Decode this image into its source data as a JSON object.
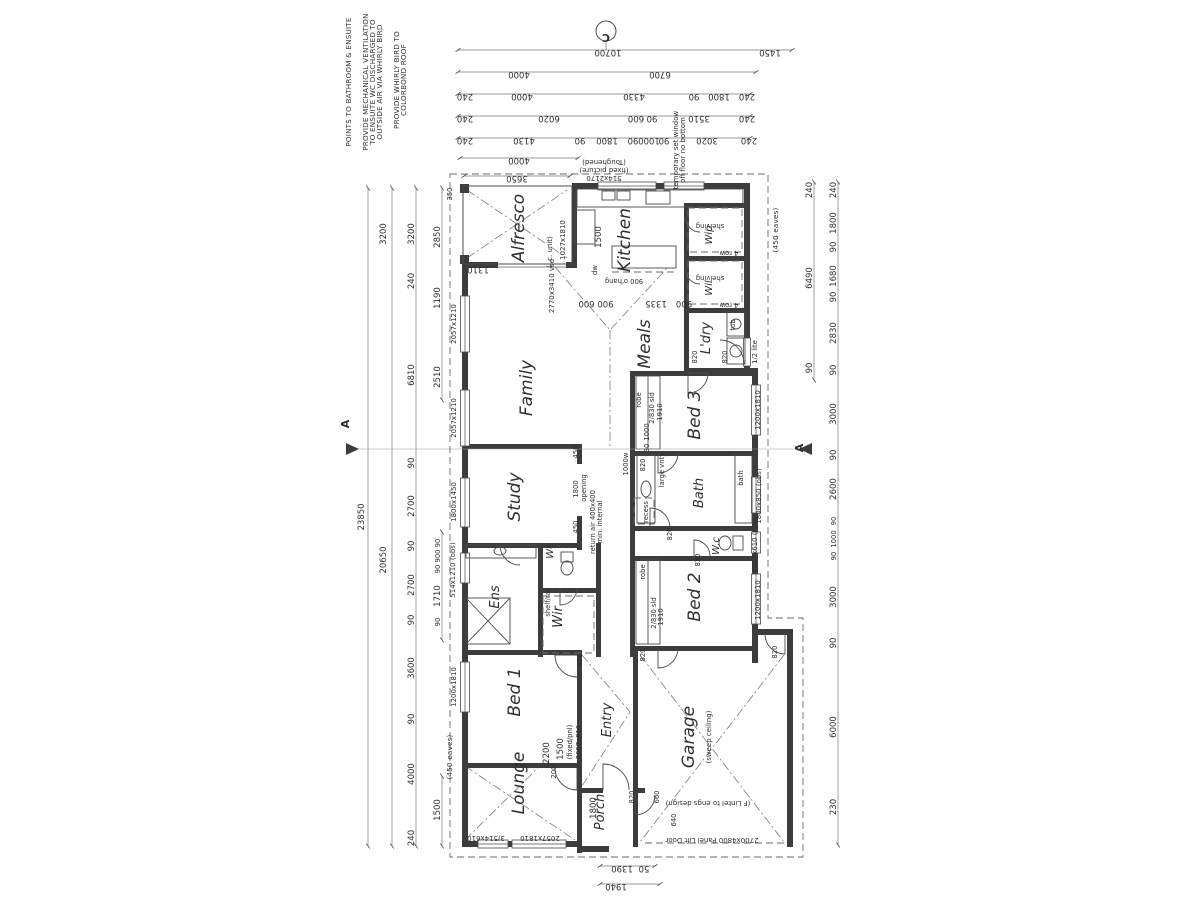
{
  "plan": {
    "background": "#ffffff",
    "ink": "#3c3c3c",
    "section_markers": {
      "c": "C",
      "a_left": "A",
      "a_right": "A"
    },
    "labels": [
      {
        "t": "POINTS TO BATHROOM & ENSUITE",
        "x": 351,
        "y": 82,
        "r": -90,
        "c": "note",
        "n": "note-bathroom-ensuite"
      },
      {
        "t": "PROVIDE MECHANICAL VENTILATION",
        "x": 368,
        "y": 82,
        "r": -90,
        "c": "note",
        "n": "note-mech-vent-1"
      },
      {
        "t": "TO ENSUITE WC DISCHARGED TO",
        "x": 375,
        "y": 82,
        "r": -90,
        "c": "note",
        "n": "note-mech-vent-2"
      },
      {
        "t": "OUTSIDE AIR VIA WHIRLY BIRD",
        "x": 382,
        "y": 82,
        "r": -90,
        "c": "note",
        "n": "note-mech-vent-3"
      },
      {
        "t": "PROVIDE WHIRLY BIRD TO",
        "x": 399,
        "y": 80,
        "r": -90,
        "c": "note",
        "n": "note-whirly-1"
      },
      {
        "t": "COLORBOND ROOF",
        "x": 406,
        "y": 80,
        "r": -90,
        "c": "note",
        "n": "note-whirly-2"
      },
      {
        "t": "C",
        "x": 606,
        "y": 34,
        "r": 180,
        "c": "mark",
        "n": "section-marker-c"
      },
      {
        "t": "A",
        "x": 349,
        "y": 424,
        "r": -90,
        "c": "mark",
        "n": "section-marker-a-left"
      },
      {
        "t": "A",
        "x": 803,
        "y": 448,
        "r": -90,
        "c": "mark",
        "n": "section-marker-a-right"
      },
      {
        "t": "10700",
        "x": 608,
        "y": 50,
        "r": 180
      },
      {
        "t": "1450",
        "x": 770,
        "y": 50,
        "r": 180
      },
      {
        "t": "4000",
        "x": 519,
        "y": 72,
        "r": 180
      },
      {
        "t": "6700",
        "x": 660,
        "y": 72,
        "r": 180
      },
      {
        "t": "240",
        "x": 465,
        "y": 94,
        "r": 180
      },
      {
        "t": "4000",
        "x": 522,
        "y": 94,
        "r": 180
      },
      {
        "t": "4330",
        "x": 634,
        "y": 94,
        "r": 180
      },
      {
        "t": "90",
        "x": 694,
        "y": 94,
        "r": 180
      },
      {
        "t": "1800",
        "x": 719,
        "y": 94,
        "r": 180
      },
      {
        "t": "240",
        "x": 747,
        "y": 94,
        "r": 180
      },
      {
        "t": "240",
        "x": 465,
        "y": 116,
        "r": 180
      },
      {
        "t": "6020",
        "x": 549,
        "y": 116,
        "r": 180
      },
      {
        "t": "600",
        "x": 636,
        "y": 116,
        "r": 180
      },
      {
        "t": "90",
        "x": 652,
        "y": 116,
        "r": 180
      },
      {
        "t": "3510",
        "x": 699,
        "y": 116,
        "r": 180
      },
      {
        "t": "240",
        "x": 747,
        "y": 116,
        "r": 180
      },
      {
        "t": "240",
        "x": 465,
        "y": 138,
        "r": 180
      },
      {
        "t": "4130",
        "x": 524,
        "y": 138,
        "r": 180
      },
      {
        "t": "90",
        "x": 580,
        "y": 138,
        "r": 180
      },
      {
        "t": "1800",
        "x": 607,
        "y": 138,
        "r": 180
      },
      {
        "t": "90",
        "x": 633,
        "y": 138,
        "r": 180
      },
      {
        "t": "1000",
        "x": 649,
        "y": 138,
        "r": 180
      },
      {
        "t": "90",
        "x": 664,
        "y": 138,
        "r": 180
      },
      {
        "t": "3020",
        "x": 707,
        "y": 138,
        "r": 180
      },
      {
        "t": "240",
        "x": 749,
        "y": 138,
        "r": 180
      },
      {
        "t": "4000",
        "x": 519,
        "y": 158,
        "r": 180
      },
      {
        "t": "3650",
        "x": 517,
        "y": 176,
        "r": 180
      },
      {
        "t": "23850",
        "x": 364,
        "y": 517,
        "r": -90
      },
      {
        "t": "3200",
        "x": 386,
        "y": 234,
        "r": -90
      },
      {
        "t": "20650",
        "x": 386,
        "y": 560,
        "r": -90
      },
      {
        "t": "3200",
        "x": 414,
        "y": 234,
        "r": -90
      },
      {
        "t": "240",
        "x": 414,
        "y": 281,
        "r": -90
      },
      {
        "t": "6810",
        "x": 414,
        "y": 375,
        "r": -90
      },
      {
        "t": "90",
        "x": 414,
        "y": 463,
        "r": -90
      },
      {
        "t": "2700",
        "x": 414,
        "y": 506,
        "r": -90
      },
      {
        "t": "90",
        "x": 414,
        "y": 546,
        "r": -90
      },
      {
        "t": "2700",
        "x": 414,
        "y": 585,
        "r": -90
      },
      {
        "t": "90",
        "x": 414,
        "y": 620,
        "r": -90
      },
      {
        "t": "3600",
        "x": 414,
        "y": 668,
        "r": -90
      },
      {
        "t": "90",
        "x": 414,
        "y": 719,
        "r": -90
      },
      {
        "t": "4000",
        "x": 414,
        "y": 774,
        "r": -90
      },
      {
        "t": "240",
        "x": 414,
        "y": 838,
        "r": -90
      },
      {
        "t": "2850",
        "x": 440,
        "y": 237,
        "r": -90
      },
      {
        "t": "1190",
        "x": 440,
        "y": 298,
        "r": -90
      },
      {
        "t": "2510",
        "x": 440,
        "y": 377,
        "r": -90
      },
      {
        "t": "90",
        "x": 440,
        "y": 543,
        "r": -90,
        "c": "dims"
      },
      {
        "t": "900",
        "x": 440,
        "y": 556,
        "r": -90,
        "c": "dims"
      },
      {
        "t": "90",
        "x": 440,
        "y": 569,
        "r": -90,
        "c": "dims"
      },
      {
        "t": "1710",
        "x": 440,
        "y": 596,
        "r": -90
      },
      {
        "t": "90",
        "x": 440,
        "y": 622,
        "r": -90,
        "c": "dims"
      },
      {
        "t": "1500",
        "x": 440,
        "y": 810,
        "r": -90
      },
      {
        "t": "350",
        "x": 452,
        "y": 194,
        "r": -90,
        "c": "dims"
      },
      {
        "t": "(450 eaves)",
        "x": 452,
        "y": 757,
        "r": -90,
        "c": "note"
      },
      {
        "t": "240",
        "x": 812,
        "y": 190,
        "r": -90
      },
      {
        "t": "6490",
        "x": 812,
        "y": 278,
        "r": -90
      },
      {
        "t": "90",
        "x": 812,
        "y": 368,
        "r": -90
      },
      {
        "t": "240",
        "x": 836,
        "y": 190,
        "r": -90
      },
      {
        "t": "1800",
        "x": 836,
        "y": 223,
        "r": -90
      },
      {
        "t": "90",
        "x": 836,
        "y": 247,
        "r": -90
      },
      {
        "t": "1680",
        "x": 836,
        "y": 276,
        "r": -90
      },
      {
        "t": "90",
        "x": 836,
        "y": 297,
        "r": -90
      },
      {
        "t": "2830",
        "x": 836,
        "y": 333,
        "r": -90
      },
      {
        "t": "90",
        "x": 836,
        "y": 370,
        "r": -90
      },
      {
        "t": "3000",
        "x": 836,
        "y": 414,
        "r": -90
      },
      {
        "t": "90",
        "x": 836,
        "y": 455,
        "r": -90
      },
      {
        "t": "2600",
        "x": 836,
        "y": 489,
        "r": -90
      },
      {
        "t": "90",
        "x": 836,
        "y": 521,
        "r": -90,
        "c": "dims"
      },
      {
        "t": "1000",
        "x": 836,
        "y": 539,
        "r": -90,
        "c": "dims"
      },
      {
        "t": "90",
        "x": 836,
        "y": 556,
        "r": -90,
        "c": "dims"
      },
      {
        "t": "3000",
        "x": 836,
        "y": 597,
        "r": -90
      },
      {
        "t": "90",
        "x": 836,
        "y": 643,
        "r": -90
      },
      {
        "t": "6000",
        "x": 836,
        "y": 727,
        "r": -90
      },
      {
        "t": "230",
        "x": 836,
        "y": 807,
        "r": -90
      },
      {
        "t": "(450 eaves)",
        "x": 778,
        "y": 230,
        "r": -90,
        "c": "note"
      },
      {
        "t": "1390",
        "x": 622,
        "y": 866,
        "r": 180
      },
      {
        "t": "50",
        "x": 644,
        "y": 866,
        "r": 180
      },
      {
        "t": "1940",
        "x": 616,
        "y": 884,
        "r": 180
      },
      {
        "t": "2700x4800 Panel Lift Door",
        "x": 712,
        "y": 838,
        "r": 180,
        "c": "win"
      },
      {
        "t": "(F Lintel to engs design)",
        "x": 708,
        "y": 801,
        "r": 180,
        "c": "win"
      },
      {
        "t": "3/514x610",
        "x": 486,
        "y": 836,
        "r": 180,
        "c": "win"
      },
      {
        "t": "2057x1810",
        "x": 540,
        "y": 836,
        "r": 180,
        "c": "win"
      },
      {
        "t": "Alfresco",
        "x": 524,
        "y": 228,
        "r": -90,
        "c": "room",
        "n": "room-alfresco"
      },
      {
        "t": "Kitchen",
        "x": 630,
        "y": 240,
        "r": -90,
        "c": "room",
        "n": "room-kitchen"
      },
      {
        "t": "Wip",
        "x": 712,
        "y": 235,
        "r": -90,
        "c": "rsm",
        "n": "room-wip"
      },
      {
        "t": "Wil",
        "x": 712,
        "y": 288,
        "r": -90,
        "c": "rsm",
        "n": "room-wil"
      },
      {
        "t": "L'dry",
        "x": 710,
        "y": 338,
        "r": -90,
        "c": "rmed",
        "n": "room-ldry"
      },
      {
        "t": "Meals",
        "x": 650,
        "y": 344,
        "r": -90,
        "c": "room",
        "n": "room-meals"
      },
      {
        "t": "Family",
        "x": 532,
        "y": 388,
        "r": -90,
        "c": "room",
        "n": "room-family"
      },
      {
        "t": "Bed 3",
        "x": 700,
        "y": 415,
        "r": -90,
        "c": "room",
        "n": "room-bed3"
      },
      {
        "t": "Study",
        "x": 520,
        "y": 497,
        "r": -90,
        "c": "room",
        "n": "room-study"
      },
      {
        "t": "Wc",
        "x": 553,
        "y": 551,
        "r": -90,
        "c": "rsm",
        "n": "room-wc-ens"
      },
      {
        "t": "Ens",
        "x": 499,
        "y": 597,
        "r": -90,
        "c": "rmed",
        "n": "room-ens"
      },
      {
        "t": "Wir",
        "x": 562,
        "y": 617,
        "r": -90,
        "c": "rmed",
        "n": "room-wir"
      },
      {
        "t": "Bath",
        "x": 703,
        "y": 493,
        "r": -90,
        "c": "rmed",
        "n": "room-bath"
      },
      {
        "t": "W.c",
        "x": 719,
        "y": 546,
        "r": -90,
        "c": "rsm",
        "n": "room-wc"
      },
      {
        "t": "Bed 2",
        "x": 700,
        "y": 597,
        "r": -90,
        "c": "room",
        "n": "room-bed2"
      },
      {
        "t": "Bed 1",
        "x": 520,
        "y": 692,
        "r": -90,
        "c": "room",
        "n": "room-bed1"
      },
      {
        "t": "Entry",
        "x": 611,
        "y": 720,
        "r": -90,
        "c": "rmed",
        "n": "room-entry"
      },
      {
        "t": "Lounge",
        "x": 524,
        "y": 783,
        "r": -90,
        "c": "room",
        "n": "room-lounge"
      },
      {
        "t": "Garage",
        "x": 694,
        "y": 737,
        "r": -90,
        "c": "room",
        "n": "room-garage"
      },
      {
        "t": "(sweep ceiling)",
        "x": 711,
        "y": 737,
        "r": -90,
        "c": "win"
      },
      {
        "t": "Porch",
        "x": 604,
        "y": 812,
        "r": -90,
        "c": "rmed",
        "n": "room-porch"
      },
      {
        "t": "514x2170",
        "x": 604,
        "y": 176,
        "r": 180,
        "c": "win"
      },
      {
        "t": "(fixed picture)",
        "x": 604,
        "y": 168,
        "r": 180,
        "c": "win"
      },
      {
        "t": "(Toughened)",
        "x": 604,
        "y": 160,
        "r": 180,
        "c": "win"
      },
      {
        "t": "temporary set window",
        "x": 678,
        "y": 150,
        "r": -90,
        "c": "win"
      },
      {
        "t": "off floor no bottom",
        "x": 685,
        "y": 150,
        "r": -90,
        "c": "win"
      },
      {
        "t": "1500",
        "x": 601,
        "y": 237,
        "r": -90
      },
      {
        "t": "dw",
        "x": 597,
        "y": 270,
        "r": -90,
        "c": "dims"
      },
      {
        "t": "900 o'hang",
        "x": 624,
        "y": 279,
        "r": 180,
        "c": "dims"
      },
      {
        "t": "900 600",
        "x": 596,
        "y": 301,
        "r": 180
      },
      {
        "t": "1335",
        "x": 656,
        "y": 301,
        "r": 180
      },
      {
        "t": "900",
        "x": 684,
        "y": 301,
        "r": 180
      },
      {
        "t": "2770x3410 vsd",
        "x": 554,
        "y": 286,
        "r": -90,
        "c": "win"
      },
      {
        "t": "1027x1810",
        "x": 565,
        "y": 240,
        "r": -90,
        "c": "win"
      },
      {
        "t": "(i.c. unit)",
        "x": 552,
        "y": 252,
        "r": -90,
        "c": "win"
      },
      {
        "t": "1310",
        "x": 478,
        "y": 267,
        "r": 180
      },
      {
        "t": "shelving",
        "x": 710,
        "y": 224,
        "r": 180,
        "c": "dims"
      },
      {
        "t": "4 row",
        "x": 729,
        "y": 251,
        "r": 180,
        "c": "dims"
      },
      {
        "t": "shelving",
        "x": 710,
        "y": 276,
        "r": 180,
        "c": "dims"
      },
      {
        "t": "4 row",
        "x": 729,
        "y": 303,
        "r": 180,
        "c": "dims"
      },
      {
        "t": "tub",
        "x": 735,
        "y": 325,
        "r": -90,
        "c": "dims"
      },
      {
        "t": "1/2 lite",
        "x": 757,
        "y": 352,
        "r": -90,
        "c": "dims"
      },
      {
        "t": "820",
        "x": 697,
        "y": 357,
        "r": -90,
        "c": "dims"
      },
      {
        "t": "820",
        "x": 727,
        "y": 357,
        "r": -90,
        "c": "dims"
      },
      {
        "t": "robe",
        "x": 641,
        "y": 400,
        "r": -90,
        "c": "dims"
      },
      {
        "t": "2/830 sld",
        "x": 654,
        "y": 408,
        "r": -90,
        "c": "dims"
      },
      {
        "t": "1910",
        "x": 662,
        "y": 412,
        "r": -90,
        "c": "dims"
      },
      {
        "t": "1000",
        "x": 649,
        "y": 432,
        "r": -90,
        "c": "dims"
      },
      {
        "t": "90",
        "x": 649,
        "y": 448,
        "r": -90,
        "c": "dims"
      },
      {
        "t": "1200x1810",
        "x": 760,
        "y": 410,
        "r": -90,
        "c": "win"
      },
      {
        "t": "820",
        "x": 645,
        "y": 465,
        "r": -90,
        "c": "dims"
      },
      {
        "t": "large vnty",
        "x": 664,
        "y": 470,
        "r": -90,
        "c": "dims"
      },
      {
        "t": "1000w",
        "x": 628,
        "y": 464,
        "r": -90,
        "c": "dims"
      },
      {
        "t": "bath",
        "x": 743,
        "y": 478,
        "r": -90,
        "c": "dims"
      },
      {
        "t": "1800x850 (obs)",
        "x": 761,
        "y": 496,
        "r": -90,
        "c": "win"
      },
      {
        "t": "1027x610 (obs)",
        "x": 757,
        "y": 545,
        "r": -90,
        "c": "win"
      },
      {
        "t": "recess",
        "x": 648,
        "y": 512,
        "r": -90,
        "c": "dims"
      },
      {
        "t": "820",
        "x": 672,
        "y": 534,
        "r": -90,
        "c": "dims"
      },
      {
        "t": "820",
        "x": 700,
        "y": 560,
        "r": -90,
        "c": "dims"
      },
      {
        "t": "robe",
        "x": 645,
        "y": 572,
        "r": -90,
        "c": "dims"
      },
      {
        "t": "2/830 sld",
        "x": 656,
        "y": 613,
        "r": -90,
        "c": "dims"
      },
      {
        "t": "1910",
        "x": 663,
        "y": 617,
        "r": -90,
        "c": "dims"
      },
      {
        "t": "1200x1810",
        "x": 760,
        "y": 600,
        "r": -90,
        "c": "win"
      },
      {
        "t": "820",
        "x": 645,
        "y": 655,
        "r": -90,
        "c": "dims"
      },
      {
        "t": "opening",
        "x": 586,
        "y": 488,
        "r": -90,
        "c": "dims"
      },
      {
        "t": "1800",
        "x": 578,
        "y": 489,
        "r": -90,
        "c": "dims"
      },
      {
        "t": "450",
        "x": 578,
        "y": 452,
        "r": -90,
        "c": "dims"
      },
      {
        "t": "450",
        "x": 578,
        "y": 527,
        "r": -90,
        "c": "dims"
      },
      {
        "t": "return air 400x400",
        "x": 595,
        "y": 522,
        "r": -90,
        "c": "dims"
      },
      {
        "t": "min. internal",
        "x": 602,
        "y": 522,
        "r": -90,
        "c": "dims"
      },
      {
        "t": "shelf/rail",
        "x": 550,
        "y": 602,
        "r": -90,
        "c": "dims"
      },
      {
        "t": "2057x1210",
        "x": 456,
        "y": 324,
        "r": -90,
        "c": "win"
      },
      {
        "t": "2057x1210",
        "x": 456,
        "y": 418,
        "r": -90,
        "c": "win"
      },
      {
        "t": "1800x1450",
        "x": 456,
        "y": 502,
        "r": -90,
        "c": "win"
      },
      {
        "t": "514x1210 (obs)",
        "x": 455,
        "y": 570,
        "r": -90,
        "c": "win"
      },
      {
        "t": "1200x1810",
        "x": 456,
        "y": 687,
        "r": -90,
        "c": "win"
      },
      {
        "t": "820",
        "x": 582,
        "y": 660,
        "r": -90,
        "c": "dims"
      },
      {
        "t": "2200",
        "x": 549,
        "y": 753,
        "r": -90
      },
      {
        "t": "1500",
        "x": 563,
        "y": 749,
        "r": -90
      },
      {
        "t": "200",
        "x": 556,
        "y": 772,
        "r": -90,
        "c": "dims"
      },
      {
        "t": "(fixed/pnl)",
        "x": 572,
        "y": 742,
        "r": -90,
        "c": "dims"
      },
      {
        "t": "2057x810",
        "x": 581,
        "y": 742,
        "r": -90,
        "c": "dims"
      },
      {
        "t": "1800",
        "x": 596,
        "y": 808,
        "r": -90
      },
      {
        "t": "820",
        "x": 634,
        "y": 797,
        "r": -90,
        "c": "dims"
      },
      {
        "t": "660",
        "x": 659,
        "y": 797,
        "r": -90,
        "c": "dims"
      },
      {
        "t": "640",
        "x": 676,
        "y": 820,
        "r": -90,
        "c": "dims"
      },
      {
        "t": "820",
        "x": 777,
        "y": 652,
        "r": -90,
        "c": "dims"
      }
    ]
  }
}
